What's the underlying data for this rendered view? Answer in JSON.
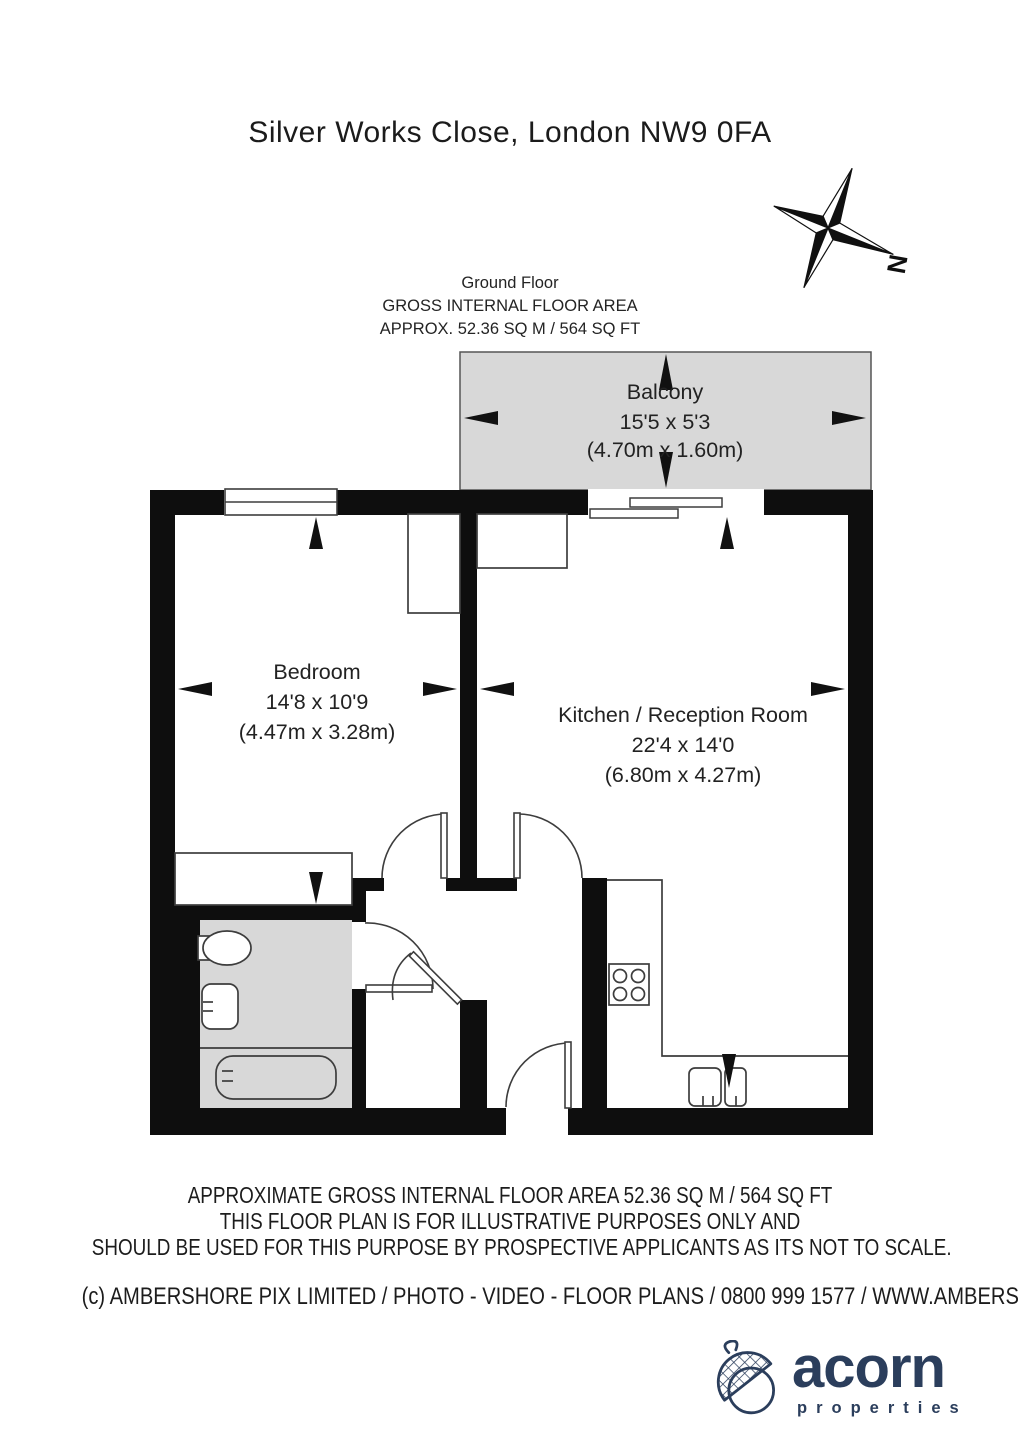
{
  "page": {
    "title": "Silver Works Close, London NW9 0FA"
  },
  "floor_summary": {
    "line1": "Ground Floor",
    "line2": "GROSS INTERNAL FLOOR AREA",
    "line3": "APPROX. 52.36 SQ M / 564 SQ FT"
  },
  "compass": {
    "label": "N"
  },
  "rooms": {
    "balcony": {
      "name": "Balcony",
      "imperial": "15'5 x 5'3",
      "metric": "(4.70m x 1.60m)"
    },
    "bedroom": {
      "name": "Bedroom",
      "imperial": "14'8 x 10'9",
      "metric": "(4.47m x 3.28m)"
    },
    "kitchen": {
      "name": "Kitchen / Reception Room",
      "imperial": "22'4 x 14'0",
      "metric": "(6.80m x 4.27m)"
    }
  },
  "disclaimer": {
    "line1": "APPROXIMATE GROSS INTERNAL FLOOR AREA 52.36 SQ M / 564 SQ FT",
    "line2": "THIS FLOOR PLAN IS FOR ILLUSTRATIVE PURPOSES ONLY AND",
    "line3": "SHOULD BE USED FOR THIS PURPOSE BY PROSPECTIVE APPLICANTS AS ITS NOT TO SCALE."
  },
  "copyright": "(c) AMBERSHORE PIX LIMITED / PHOTO - VIDEO - FLOOR PLANS / 0800 999 1577 / WWW.AMBERSHOREPIX.CO.UK",
  "logo": {
    "brand": "acorn",
    "tagline": "p r o p e r t i e s"
  },
  "colors": {
    "wall": "#0e0e0e",
    "area_fill": "#d8d8d8",
    "line": "#3d3d3d",
    "brand_navy": "#2b3e5c"
  }
}
